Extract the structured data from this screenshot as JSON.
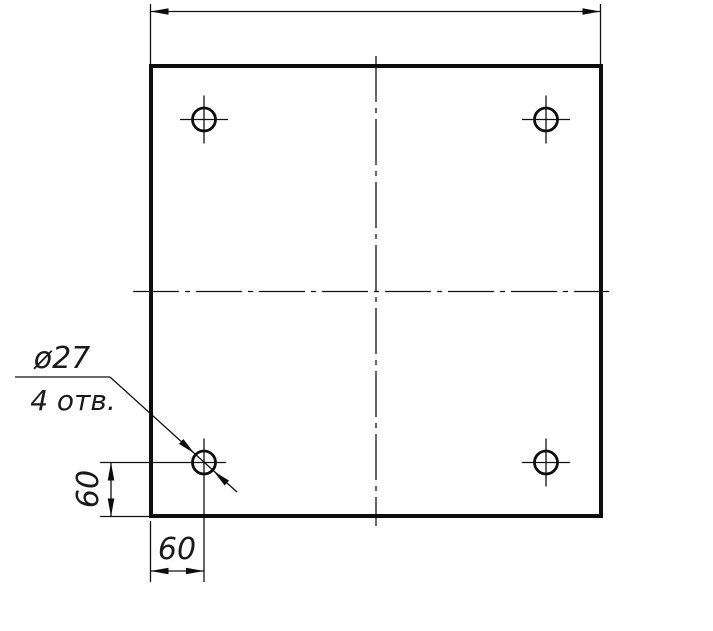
{
  "drawing": {
    "title": "plate-with-four-holes",
    "leader": {
      "diameter_label": "ø27",
      "count_label": "4 отв."
    },
    "dimensions": {
      "hole_offset_vertical": "60",
      "hole_offset_horizontal": "60",
      "overall_width_label": ""
    },
    "colors": {
      "line": "#0d0d0d",
      "background": "#ffffff"
    }
  }
}
